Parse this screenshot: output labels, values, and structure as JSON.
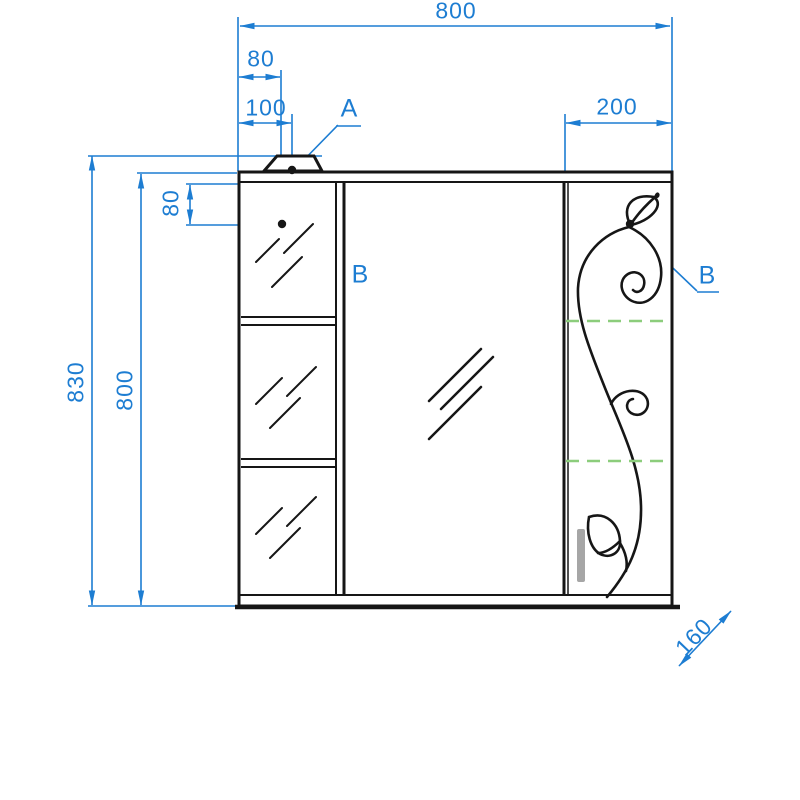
{
  "drawing": {
    "type": "technical-elevation",
    "subject": "mirror cabinet front view",
    "colors": {
      "dimension_blue": "#1d7dd2",
      "outline_black": "#161616",
      "shelf_dashed_green": "#8ccd7c",
      "handle_gray": "#a6a6a6",
      "background": "#ffffff"
    },
    "dimensions": {
      "overall_width": "800",
      "lamp_offset_left": "80",
      "lamp_center_offset": "100",
      "right_section_width": "200",
      "overall_height_with_lamp": "830",
      "cabinet_height": "800",
      "fixing_point_top_offset": "80",
      "side_depth": "160"
    },
    "callouts": {
      "lamp": "A",
      "fixing_point_left": "B",
      "fixing_point_right": "B"
    }
  }
}
